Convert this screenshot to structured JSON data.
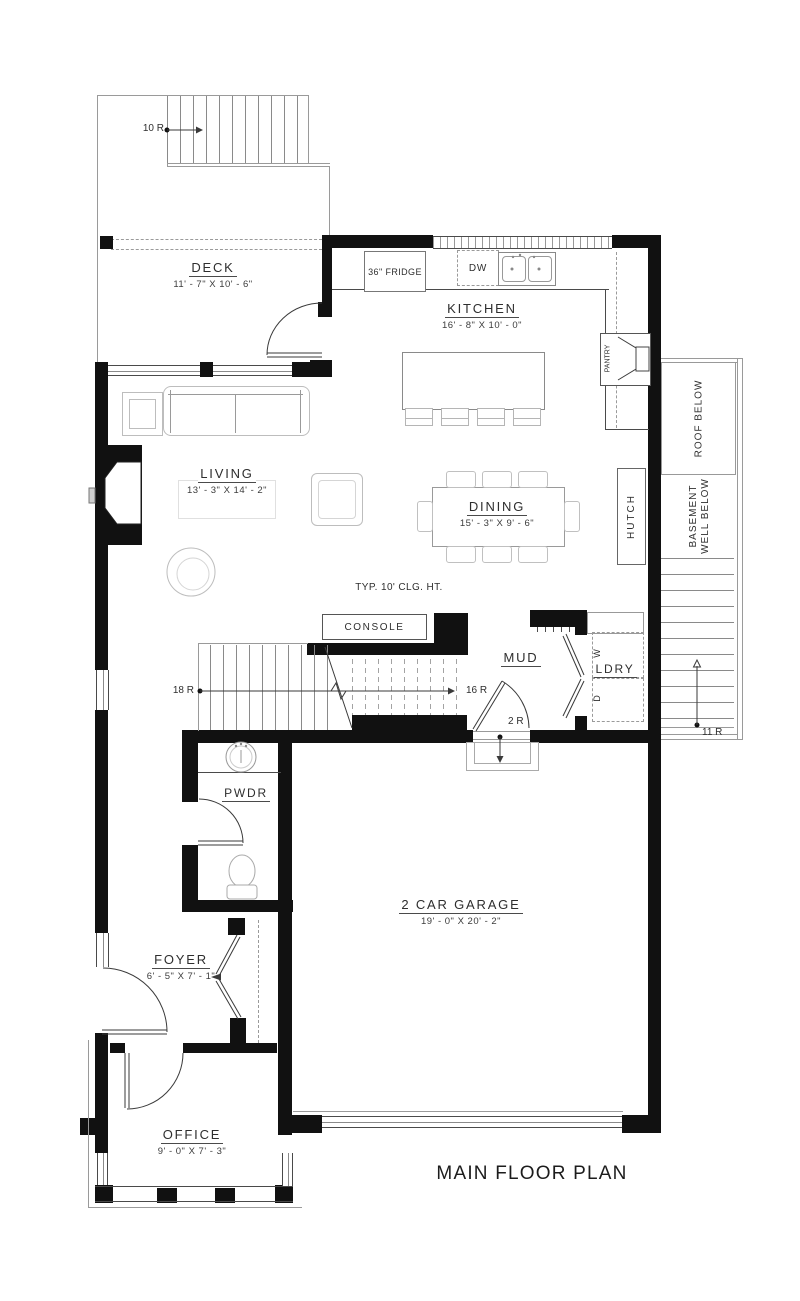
{
  "title": "MAIN FLOOR PLAN",
  "rooms": {
    "deck": {
      "name": "DECK",
      "dims": "11' - 7\" X 10' - 6\""
    },
    "kitchen": {
      "name": "KITCHEN",
      "dims": "16' - 8\" X 10' - 0\""
    },
    "living": {
      "name": "LIVING",
      "dims": "13' - 3\" X 14' - 2\""
    },
    "dining": {
      "name": "DINING",
      "dims": "15' - 3\" X 9' - 6\""
    },
    "mud": {
      "name": "MUD"
    },
    "laundry": {
      "name": "LDRY"
    },
    "powder": {
      "name": "PWDR"
    },
    "foyer": {
      "name": "FOYER",
      "dims": "6' - 5\" X 7' - 1\""
    },
    "garage": {
      "name": "2 CAR GARAGE",
      "dims": "19' - 0\" X 20' - 2\""
    },
    "office": {
      "name": "OFFICE",
      "dims": "9' - 0\" X 7' - 3\""
    }
  },
  "fixtures": {
    "fridge": "36\" FRIDGE",
    "dishwasher": "DW",
    "console": "CONSOLE",
    "hutch": "HUTCH",
    "pantry": "PANTRY",
    "washer": "W",
    "dryer": "D"
  },
  "notes": {
    "ceiling": "TYP. 10' CLG. HT.",
    "roof_below": "ROOF BELOW",
    "basement_well_1": "BASEMENT",
    "basement_well_2": "WELL BELOW"
  },
  "stairs": {
    "deck_stairs": "10 R",
    "main_stairs_up": "18 R",
    "main_stairs_upper": "16 R",
    "garage_steps": "2 R",
    "side_stairs": "11 R"
  },
  "colors": {
    "wall": "#111111",
    "furniture_line": "#bdbdbd",
    "text": "#2e2e2e"
  }
}
